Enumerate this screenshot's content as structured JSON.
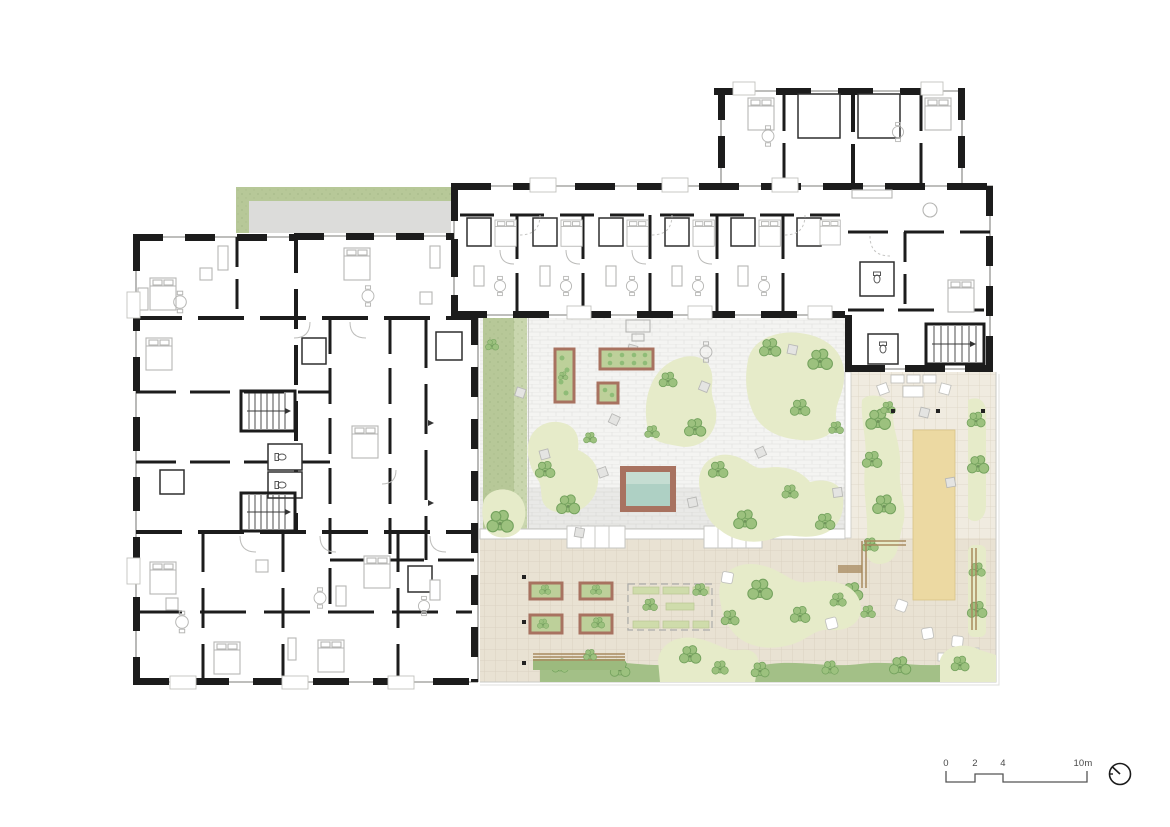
{
  "scale_bar": {
    "labels": [
      "0",
      "2",
      "4",
      "10m"
    ]
  },
  "north_indicator": {
    "icon": "north-arrow-icon"
  },
  "palette": {
    "ink": "#1c1c1c",
    "line": "#a8a8a6",
    "furn": "#b6b6b4",
    "pave": "#f4f4f2",
    "pavej": "#e4e4e1",
    "terr": "#e9e2d3",
    "terrj": "#d7cfbe",
    "gard": "#f0ebe0",
    "gardj": "#dcd5c4",
    "grass": "#b7c898",
    "grassl": "#c9d6ae",
    "patch": "#e6ebc9",
    "bush": "#9cc17e",
    "bushs": "#74a25e",
    "brown": "#a87260",
    "bedfill": "#bdd09a",
    "water": "#aed0c4",
    "waterl": "#c5ddd2",
    "sand": "#ecd9a2",
    "wood": "#a8895f",
    "label": "#4a4a4a"
  }
}
